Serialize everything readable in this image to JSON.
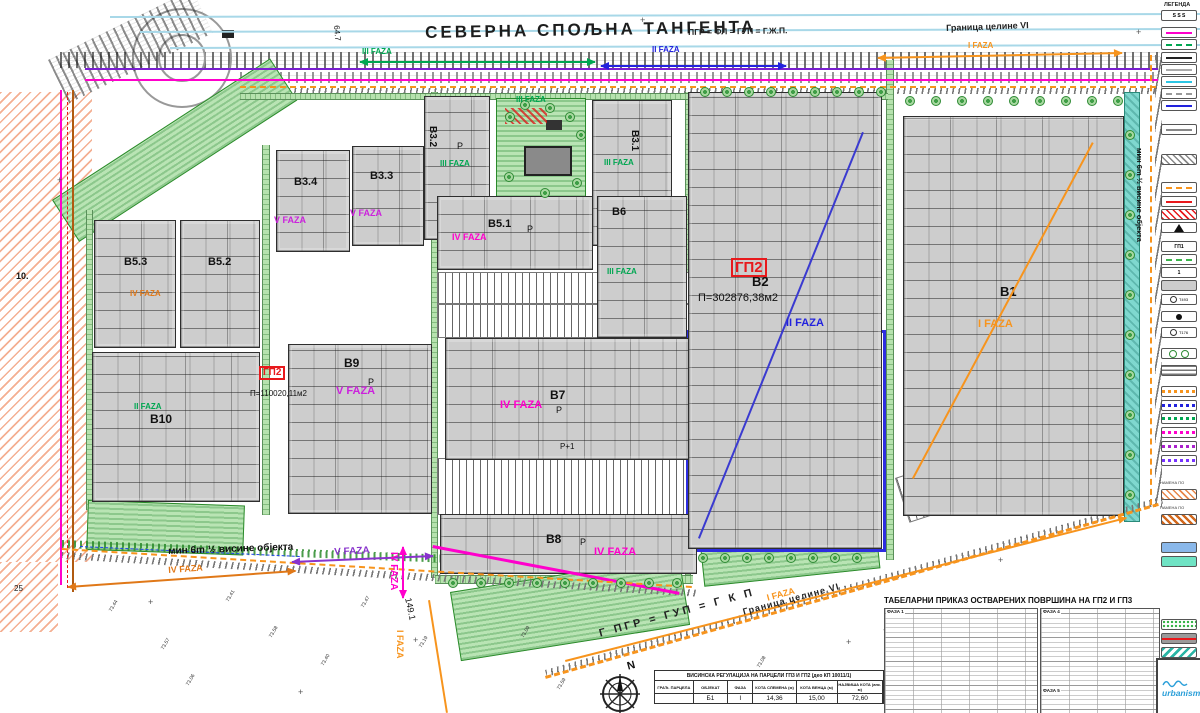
{
  "colors": {
    "green": "#00a651",
    "blue": "#2222dd",
    "orange": "#f7941d",
    "magenta": "#ff00cc",
    "purple": "#8833cc",
    "red": "#e8191c",
    "orange_dark": "#e07818"
  },
  "title_band": {
    "road_name": "СЕВЕРНА СПОЉНА ТАНГЕНТА",
    "plan_equation_top": "ПГР = ФЛ = ГУП = Г.Ж.П.",
    "border_label_top": "Граница целине VI"
  },
  "blocks": [
    {
      "id": "B10",
      "label": "B10",
      "x": 92,
      "y": 352,
      "w": 166,
      "h": 148,
      "lx": 150,
      "ly": 412,
      "ls": 12
    },
    {
      "id": "B5.3",
      "label": "B5.3",
      "x": 94,
      "y": 220,
      "w": 80,
      "h": 126,
      "lx": 124,
      "ly": 256,
      "ls": 11
    },
    {
      "id": "B5.2",
      "label": "B5.2",
      "x": 180,
      "y": 220,
      "w": 78,
      "h": 126,
      "lx": 208,
      "ly": 256,
      "ls": 11
    },
    {
      "id": "B3.4",
      "label": "B3.4",
      "x": 276,
      "y": 150,
      "w": 72,
      "h": 100,
      "lx": 294,
      "ly": 176,
      "ls": 11
    },
    {
      "id": "B3.3",
      "label": "B3.3",
      "x": 352,
      "y": 146,
      "w": 70,
      "h": 98,
      "lx": 370,
      "ly": 170,
      "ls": 11
    },
    {
      "id": "B9",
      "label": "B9",
      "x": 288,
      "y": 344,
      "w": 142,
      "h": 168,
      "lx": 344,
      "ly": 356,
      "ls": 12
    },
    {
      "id": "B3.2",
      "label": "B3.2",
      "x": 424,
      "y": 96,
      "w": 64,
      "h": 142,
      "lx": 438,
      "ly": 126,
      "ls": 10,
      "lr": 90
    },
    {
      "id": "B3.1",
      "label": "B3.1",
      "x": 592,
      "y": 100,
      "w": 78,
      "h": 144,
      "lx": 640,
      "ly": 130,
      "ls": 10,
      "lr": 90
    },
    {
      "id": "B5.1",
      "label": "B5.1",
      "x": 437,
      "y": 196,
      "w": 154,
      "h": 72,
      "lx": 488,
      "ly": 218,
      "ls": 11
    },
    {
      "id": "B6",
      "label": "B6",
      "x": 597,
      "y": 196,
      "w": 88,
      "h": 140,
      "lx": 612,
      "ly": 206,
      "ls": 11
    },
    {
      "id": "B7",
      "label": "B7",
      "x": 445,
      "y": 338,
      "w": 250,
      "h": 120,
      "lx": 550,
      "ly": 388,
      "ls": 12
    },
    {
      "id": "B8",
      "label": "B8",
      "x": 440,
      "y": 514,
      "w": 255,
      "h": 58,
      "lx": 546,
      "ly": 532,
      "ls": 12
    },
    {
      "id": "B2",
      "label": "B2",
      "x": 688,
      "y": 92,
      "w": 192,
      "h": 455,
      "lx": 752,
      "ly": 274,
      "ls": 13
    },
    {
      "id": "B1",
      "label": "B1",
      "x": 903,
      "y": 116,
      "w": 219,
      "h": 398,
      "lx": 1000,
      "ly": 284,
      "ls": 13
    }
  ],
  "labels": [
    {
      "n": "road-name-label",
      "t": "СЕВЕРНА СПОЉНА ТАНГЕНТА",
      "x": 425,
      "y": 24,
      "c": "#1d1d1d",
      "s": 17,
      "b": 1,
      "ls": 3,
      "r": -1
    },
    {
      "n": "plan-equation-top",
      "t": "ПГР = ФЛ = ГУП = Г.Ж.П.",
      "x": 688,
      "y": 28,
      "c": "#222",
      "s": 8.5,
      "b": 1,
      "r": -1
    },
    {
      "n": "border-label-top",
      "t": "Граница целине VI",
      "x": 946,
      "y": 24,
      "c": "#222",
      "s": 9,
      "b": 1,
      "r": -2
    },
    {
      "n": "phase-3-top-arrow",
      "t": "III FAZA",
      "x": 362,
      "y": 48,
      "c": "#00a651",
      "s": 8,
      "b": 1
    },
    {
      "n": "phase-2-top-arrow",
      "t": "II FAZA",
      "x": 652,
      "y": 46,
      "c": "#2222dd",
      "s": 8,
      "b": 1
    },
    {
      "n": "phase-1-top-arrow",
      "t": "I FAZA",
      "x": 968,
      "y": 42,
      "c": "#f7941d",
      "s": 8,
      "b": 1
    },
    {
      "n": "phase-3-top-center",
      "t": "III FAZA",
      "x": 516,
      "y": 96,
      "c": "#00a651",
      "s": 8,
      "b": 1
    },
    {
      "n": "phase-3-b32",
      "t": "III FAZA",
      "x": 440,
      "y": 160,
      "c": "#00a651",
      "s": 8,
      "b": 1
    },
    {
      "n": "phase-3-b31",
      "t": "III FAZA",
      "x": 604,
      "y": 159,
      "c": "#00a651",
      "s": 8,
      "b": 1
    },
    {
      "n": "phase-3-b6",
      "t": "III FAZA",
      "x": 607,
      "y": 268,
      "c": "#00a651",
      "s": 8,
      "b": 1
    },
    {
      "n": "phase-4-b51",
      "t": "IV FAZA",
      "x": 452,
      "y": 233,
      "c": "#ff00cc",
      "s": 9,
      "b": 1
    },
    {
      "n": "phase-4-b7",
      "t": "IV FAZA",
      "x": 500,
      "y": 400,
      "c": "#ff00cc",
      "s": 11,
      "b": 1
    },
    {
      "n": "phase-4-b8",
      "t": "IV FAZA",
      "x": 594,
      "y": 547,
      "c": "#ff00cc",
      "s": 11,
      "b": 1
    },
    {
      "n": "phase-5-b34",
      "t": "V FAZA",
      "x": 274,
      "y": 216,
      "c": "#cc22dd",
      "s": 9,
      "b": 1
    },
    {
      "n": "phase-5-b33",
      "t": "V FAZA",
      "x": 350,
      "y": 209,
      "c": "#cc22dd",
      "s": 9,
      "b": 1
    },
    {
      "n": "phase-5-b9",
      "t": "V FAZA",
      "x": 336,
      "y": 386,
      "c": "#cc22dd",
      "s": 11,
      "b": 1
    },
    {
      "n": "phase-2-b2",
      "t": "II FAZA",
      "x": 786,
      "y": 318,
      "c": "#2222dd",
      "s": 11,
      "b": 1
    },
    {
      "n": "phase-1-b1",
      "t": "I FAZA",
      "x": 978,
      "y": 319,
      "c": "#f7941d",
      "s": 11,
      "b": 1
    },
    {
      "n": "phase-2-b10",
      "t": "II FAZA",
      "x": 134,
      "y": 403,
      "c": "#00a651",
      "s": 8,
      "b": 1
    },
    {
      "n": "phase-4-b5x",
      "t": "IV FAZA",
      "x": 130,
      "y": 290,
      "c": "#e07818",
      "s": 8,
      "b": 1
    },
    {
      "n": "parcel-gp2-main",
      "t": "ГП2",
      "x": 731,
      "y": 258,
      "c": "#e8191c",
      "s": 15,
      "b": 1,
      "box": 1
    },
    {
      "n": "parcel-gp2-small",
      "t": "ГП2",
      "x": 259,
      "y": 366,
      "c": "#e8191c",
      "s": 10,
      "b": 1,
      "box": 1
    },
    {
      "n": "area-b2",
      "t": "П=302876,38м2",
      "x": 698,
      "y": 293,
      "c": "#111",
      "s": 11
    },
    {
      "n": "area-b9",
      "t": "П=110020,11м2",
      "x": 250,
      "y": 390,
      "c": "#111",
      "s": 8
    },
    {
      "n": "setback-note-bottom",
      "t": "мин 6m ½ висине објекта",
      "x": 168,
      "y": 547,
      "c": "#111",
      "s": 10,
      "b": 1,
      "r": -2
    },
    {
      "n": "phase-5-dim",
      "t": "V FAZA",
      "x": 334,
      "y": 548,
      "c": "#8833cc",
      "s": 10,
      "b": 1,
      "r": -3
    },
    {
      "n": "phase-4-dim",
      "t": "IV FAZA",
      "x": 398,
      "y": 552,
      "c": "#ff00cc",
      "s": 10,
      "b": 1,
      "r": 90
    },
    {
      "n": "phase-1-dim-left",
      "t": "I FAZA",
      "x": 404,
      "y": 630,
      "c": "#f7941d",
      "s": 9,
      "b": 1,
      "r": 90
    },
    {
      "n": "phase-4-dim-left",
      "t": "IV FAZA",
      "x": 168,
      "y": 566,
      "c": "#e07818",
      "s": 9,
      "b": 1,
      "r": -4
    },
    {
      "n": "dim-149",
      "t": "149.1",
      "x": 412,
      "y": 597,
      "c": "#111",
      "s": 9,
      "r": 78
    },
    {
      "n": "phase-1-dim-diag",
      "t": "I FAZA",
      "x": 766,
      "y": 594,
      "c": "#f7941d",
      "s": 9,
      "b": 1,
      "r": -15
    },
    {
      "n": "border-label-bottom",
      "t": "Граница целине VI",
      "x": 742,
      "y": 608,
      "c": "#222",
      "s": 9,
      "b": 1,
      "r": -15,
      "ls": 1
    },
    {
      "n": "plan-equation-bottom",
      "t": "Г ПГР = ГУП = Г К П",
      "x": 598,
      "y": 629,
      "c": "#222",
      "s": 11,
      "b": 1,
      "r": -15,
      "ls": 3
    },
    {
      "n": "setback-note-right",
      "t": "мин 6m ½ висине објекта",
      "x": 1143,
      "y": 148,
      "c": "#111",
      "s": 7.5,
      "b": 1,
      "r": 90
    },
    {
      "n": "dim-647",
      "t": "64.7",
      "x": 340,
      "y": 25,
      "c": "#111",
      "s": 8,
      "r": 85
    },
    {
      "n": "label-10",
      "t": "10.",
      "x": 16,
      "y": 272,
      "c": "#111",
      "s": 9,
      "b": 1
    },
    {
      "n": "label-25",
      "t": "25",
      "x": 14,
      "y": 585,
      "c": "#111",
      "s": 8
    },
    {
      "n": "parking-p-1",
      "t": "Р",
      "x": 457,
      "y": 142,
      "c": "#111",
      "s": 9
    },
    {
      "n": "parking-p-2",
      "t": "Р",
      "x": 527,
      "y": 225,
      "c": "#111",
      "s": 9
    },
    {
      "n": "parking-p-3",
      "t": "Р",
      "x": 556,
      "y": 406,
      "c": "#111",
      "s": 9
    },
    {
      "n": "parking-p1-b7",
      "t": "Р+1",
      "x": 560,
      "y": 443,
      "c": "#111",
      "s": 8
    },
    {
      "n": "parking-p-4",
      "t": "Р",
      "x": 580,
      "y": 538,
      "c": "#111",
      "s": 9
    },
    {
      "n": "parking-p-5",
      "t": "Р",
      "x": 368,
      "y": 378,
      "c": "#111",
      "s": 9
    }
  ],
  "legend": {
    "title": "ЛЕГЕНДА",
    "items": [
      {
        "y": 10,
        "type": "text",
        "text": "Ѕ Ѕ Ѕ"
      },
      {
        "y": 27,
        "type": "line",
        "color": "#ff00cc"
      },
      {
        "y": 39,
        "type": "dash",
        "color": "#00a651"
      },
      {
        "y": 52,
        "type": "line",
        "color": "#222222"
      },
      {
        "y": 64,
        "type": "line",
        "color": "#aaaaaa"
      },
      {
        "y": 76,
        "type": "line",
        "color": "#2bc5e4"
      },
      {
        "y": 88,
        "type": "dash",
        "color": "#999999"
      },
      {
        "y": 100,
        "type": "line",
        "color": "#2222dd"
      },
      {
        "y": 124,
        "type": "line",
        "color": "#888888"
      },
      {
        "y": 154,
        "type": "hatch",
        "color": "#888888"
      },
      {
        "y": 182,
        "type": "dash",
        "color": "#f7941d"
      },
      {
        "y": 196,
        "type": "line",
        "color": "#e8191c"
      },
      {
        "y": 209,
        "type": "hatch",
        "color": "#e8191c"
      },
      {
        "y": 222,
        "type": "tri"
      },
      {
        "y": 241,
        "type": "text",
        "text": "ГП1"
      },
      {
        "y": 254,
        "type": "dash",
        "color": "#39b54a"
      },
      {
        "y": 267,
        "type": "text",
        "text": "1"
      },
      {
        "y": 280,
        "type": "fill",
        "color": "#cccccc"
      },
      {
        "y": 294,
        "type": "icon",
        "text": "Т493"
      },
      {
        "y": 311,
        "type": "dot"
      },
      {
        "y": 327,
        "type": "icon",
        "text": "Т176"
      },
      {
        "y": 348,
        "type": "circles"
      },
      {
        "y": 365,
        "type": "hatchh"
      },
      {
        "y": 386,
        "type": "dashbox",
        "color": "#f7941d"
      },
      {
        "y": 400,
        "type": "dashbox",
        "color": "#2222dd"
      },
      {
        "y": 413,
        "type": "dashbox",
        "color": "#00a651"
      },
      {
        "y": 427,
        "type": "dashbox",
        "color": "#ff00cc"
      },
      {
        "y": 441,
        "type": "dashbox",
        "color": "#aa22cc"
      },
      {
        "y": 455,
        "type": "dashbox",
        "color": "#7733ff"
      },
      {
        "y": 480,
        "type": "caption",
        "text": "НАМЕНА ПО"
      },
      {
        "y": 489,
        "type": "hatch",
        "color": "#e8874a"
      },
      {
        "y": 505,
        "type": "caption",
        "text": "НАМЕНА ПО"
      },
      {
        "y": 514,
        "type": "hatchd",
        "color": "#d2691e"
      },
      {
        "y": 542,
        "type": "fill",
        "color": "#8ab8ea"
      },
      {
        "y": 556,
        "type": "fill",
        "color": "#6fe3c4"
      },
      {
        "y": 619,
        "type": "dots",
        "color": "#39b54a"
      },
      {
        "y": 633,
        "type": "strike"
      },
      {
        "y": 647,
        "type": "stripes",
        "color": "#2ab5a5"
      }
    ]
  },
  "tables": {
    "areas": {
      "title": "ТАБЕЛАРНИ ПРИКАЗ ОСТВАРЕНИХ ПОВРШИНА НА ГП2 И ГП3",
      "sections": [
        "ФАЗА 1",
        "ФАЗА 4",
        "ФАЗА 5"
      ]
    },
    "height": {
      "title": "ВИСИНСКА РЕГУЛАЦИЈА НА ПАРЦЕЛИ ГП3 И ГП2 (део КП 10011/1)",
      "columns": [
        "ГРАЂ. ПАРЦЕЛА",
        "ОБЈЕКАТ",
        "ФАЗА",
        "КОТА СЛЕМЕНА (м)",
        "КОТА ВЕНЦА (м)",
        "НАЈВИША КОТА (апс. м)"
      ],
      "rows": [
        [
          "",
          "Б1",
          "I",
          "14,36",
          "15,00",
          "72,60"
        ]
      ]
    }
  },
  "logo": {
    "text": "urbanism"
  },
  "compass": {
    "label": "N"
  },
  "spot_heights": [
    {
      "v": "73.44",
      "x": 108,
      "y": 610
    },
    {
      "v": "73.57",
      "x": 160,
      "y": 648
    },
    {
      "v": "73.41",
      "x": 225,
      "y": 600
    },
    {
      "v": "73.58",
      "x": 268,
      "y": 636
    },
    {
      "v": "73.40",
      "x": 320,
      "y": 664
    },
    {
      "v": "73.47",
      "x": 360,
      "y": 606
    },
    {
      "v": "73.19",
      "x": 418,
      "y": 646
    },
    {
      "v": "73.09",
      "x": 520,
      "y": 636
    },
    {
      "v": "73.59",
      "x": 556,
      "y": 688
    },
    {
      "v": "73.17",
      "x": 694,
      "y": 688
    },
    {
      "v": "73.08",
      "x": 756,
      "y": 666
    },
    {
      "v": "73.06",
      "x": 185,
      "y": 684
    }
  ],
  "arrows": [
    {
      "x1": 360,
      "y1": 61,
      "x2": 595,
      "y2": 61,
      "c": "#00a651",
      "heads": "both"
    },
    {
      "x1": 601,
      "y1": 65,
      "x2": 786,
      "y2": 65,
      "c": "#2222dd",
      "heads": "both"
    },
    {
      "x1": 878,
      "y1": 57,
      "x2": 1122,
      "y2": 52,
      "c": "#f7941d",
      "heads": "both"
    },
    {
      "x1": 292,
      "y1": 561,
      "x2": 433,
      "y2": 555,
      "c": "#8833cc",
      "heads": "both"
    },
    {
      "x1": 68,
      "y1": 586,
      "x2": 295,
      "y2": 570,
      "c": "#e07818",
      "heads": "both"
    },
    {
      "x1": 404,
      "y1": 547,
      "x2": 404,
      "y2": 598,
      "c": "#ff00cc",
      "heads": "both"
    },
    {
      "x1": 565,
      "y1": 660,
      "x2": 1126,
      "y2": 517,
      "c": "#f7941d",
      "heads": "end"
    }
  ],
  "lines": [
    {
      "x1": 110,
      "y1": 16,
      "x2": 1200,
      "y2": 13,
      "c": "#a8d8e8",
      "w": 2
    },
    {
      "x1": 140,
      "y1": 31,
      "x2": 1200,
      "y2": 28,
      "c": "#a8d8e8",
      "w": 2
    },
    {
      "x1": 170,
      "y1": 47,
      "x2": 1200,
      "y2": 44,
      "c": "#a8d8e8",
      "w": 2
    },
    {
      "x1": 85,
      "y1": 68,
      "x2": 1158,
      "y2": 68,
      "c": "#7a1fd0",
      "w": 2
    },
    {
      "x1": 85,
      "y1": 79,
      "x2": 1158,
      "y2": 79,
      "c": "#ff00cc",
      "w": 2
    },
    {
      "x1": 62,
      "y1": 90,
      "x2": 62,
      "y2": 585,
      "c": "#ff00cc",
      "w": 2
    },
    {
      "x1": 74,
      "y1": 90,
      "x2": 74,
      "y2": 592,
      "c": "#b05a10",
      "w": 2
    },
    {
      "x1": 68,
      "y1": 92,
      "x2": 68,
      "y2": 588,
      "c": "#e8191c",
      "w": 1,
      "dash": 1
    },
    {
      "x1": 240,
      "y1": 86,
      "x2": 1156,
      "y2": 86,
      "c": "#f7941d",
      "w": 2,
      "dash": 1
    },
    {
      "x1": 698,
      "y1": 538,
      "x2": 862,
      "y2": 132,
      "c": "#3a3ad0",
      "w": 2
    },
    {
      "x1": 912,
      "y1": 478,
      "x2": 1092,
      "y2": 142,
      "c": "#f7941d",
      "w": 2
    },
    {
      "x1": 80,
      "y1": 546,
      "x2": 300,
      "y2": 556,
      "c": "#2244ee",
      "w": 1.5,
      "dash": 1
    },
    {
      "x1": 433,
      "y1": 545,
      "x2": 680,
      "y2": 592,
      "c": "#ff00cc",
      "w": 3
    },
    {
      "x1": 430,
      "y1": 600,
      "x2": 448,
      "y2": 713,
      "c": "#f7941d",
      "w": 2
    },
    {
      "x1": 1152,
      "y1": 55,
      "x2": 1152,
      "y2": 505,
      "c": "#f7941d",
      "w": 2.5,
      "dash": 1
    },
    {
      "x1": 545,
      "y1": 676,
      "x2": 1158,
      "y2": 503,
      "c": "#f7941d",
      "w": 3,
      "dash": 1
    },
    {
      "x1": 62,
      "y1": 548,
      "x2": 692,
      "y2": 586,
      "c": "#f7941d",
      "w": 2.5,
      "dash": 1
    }
  ]
}
